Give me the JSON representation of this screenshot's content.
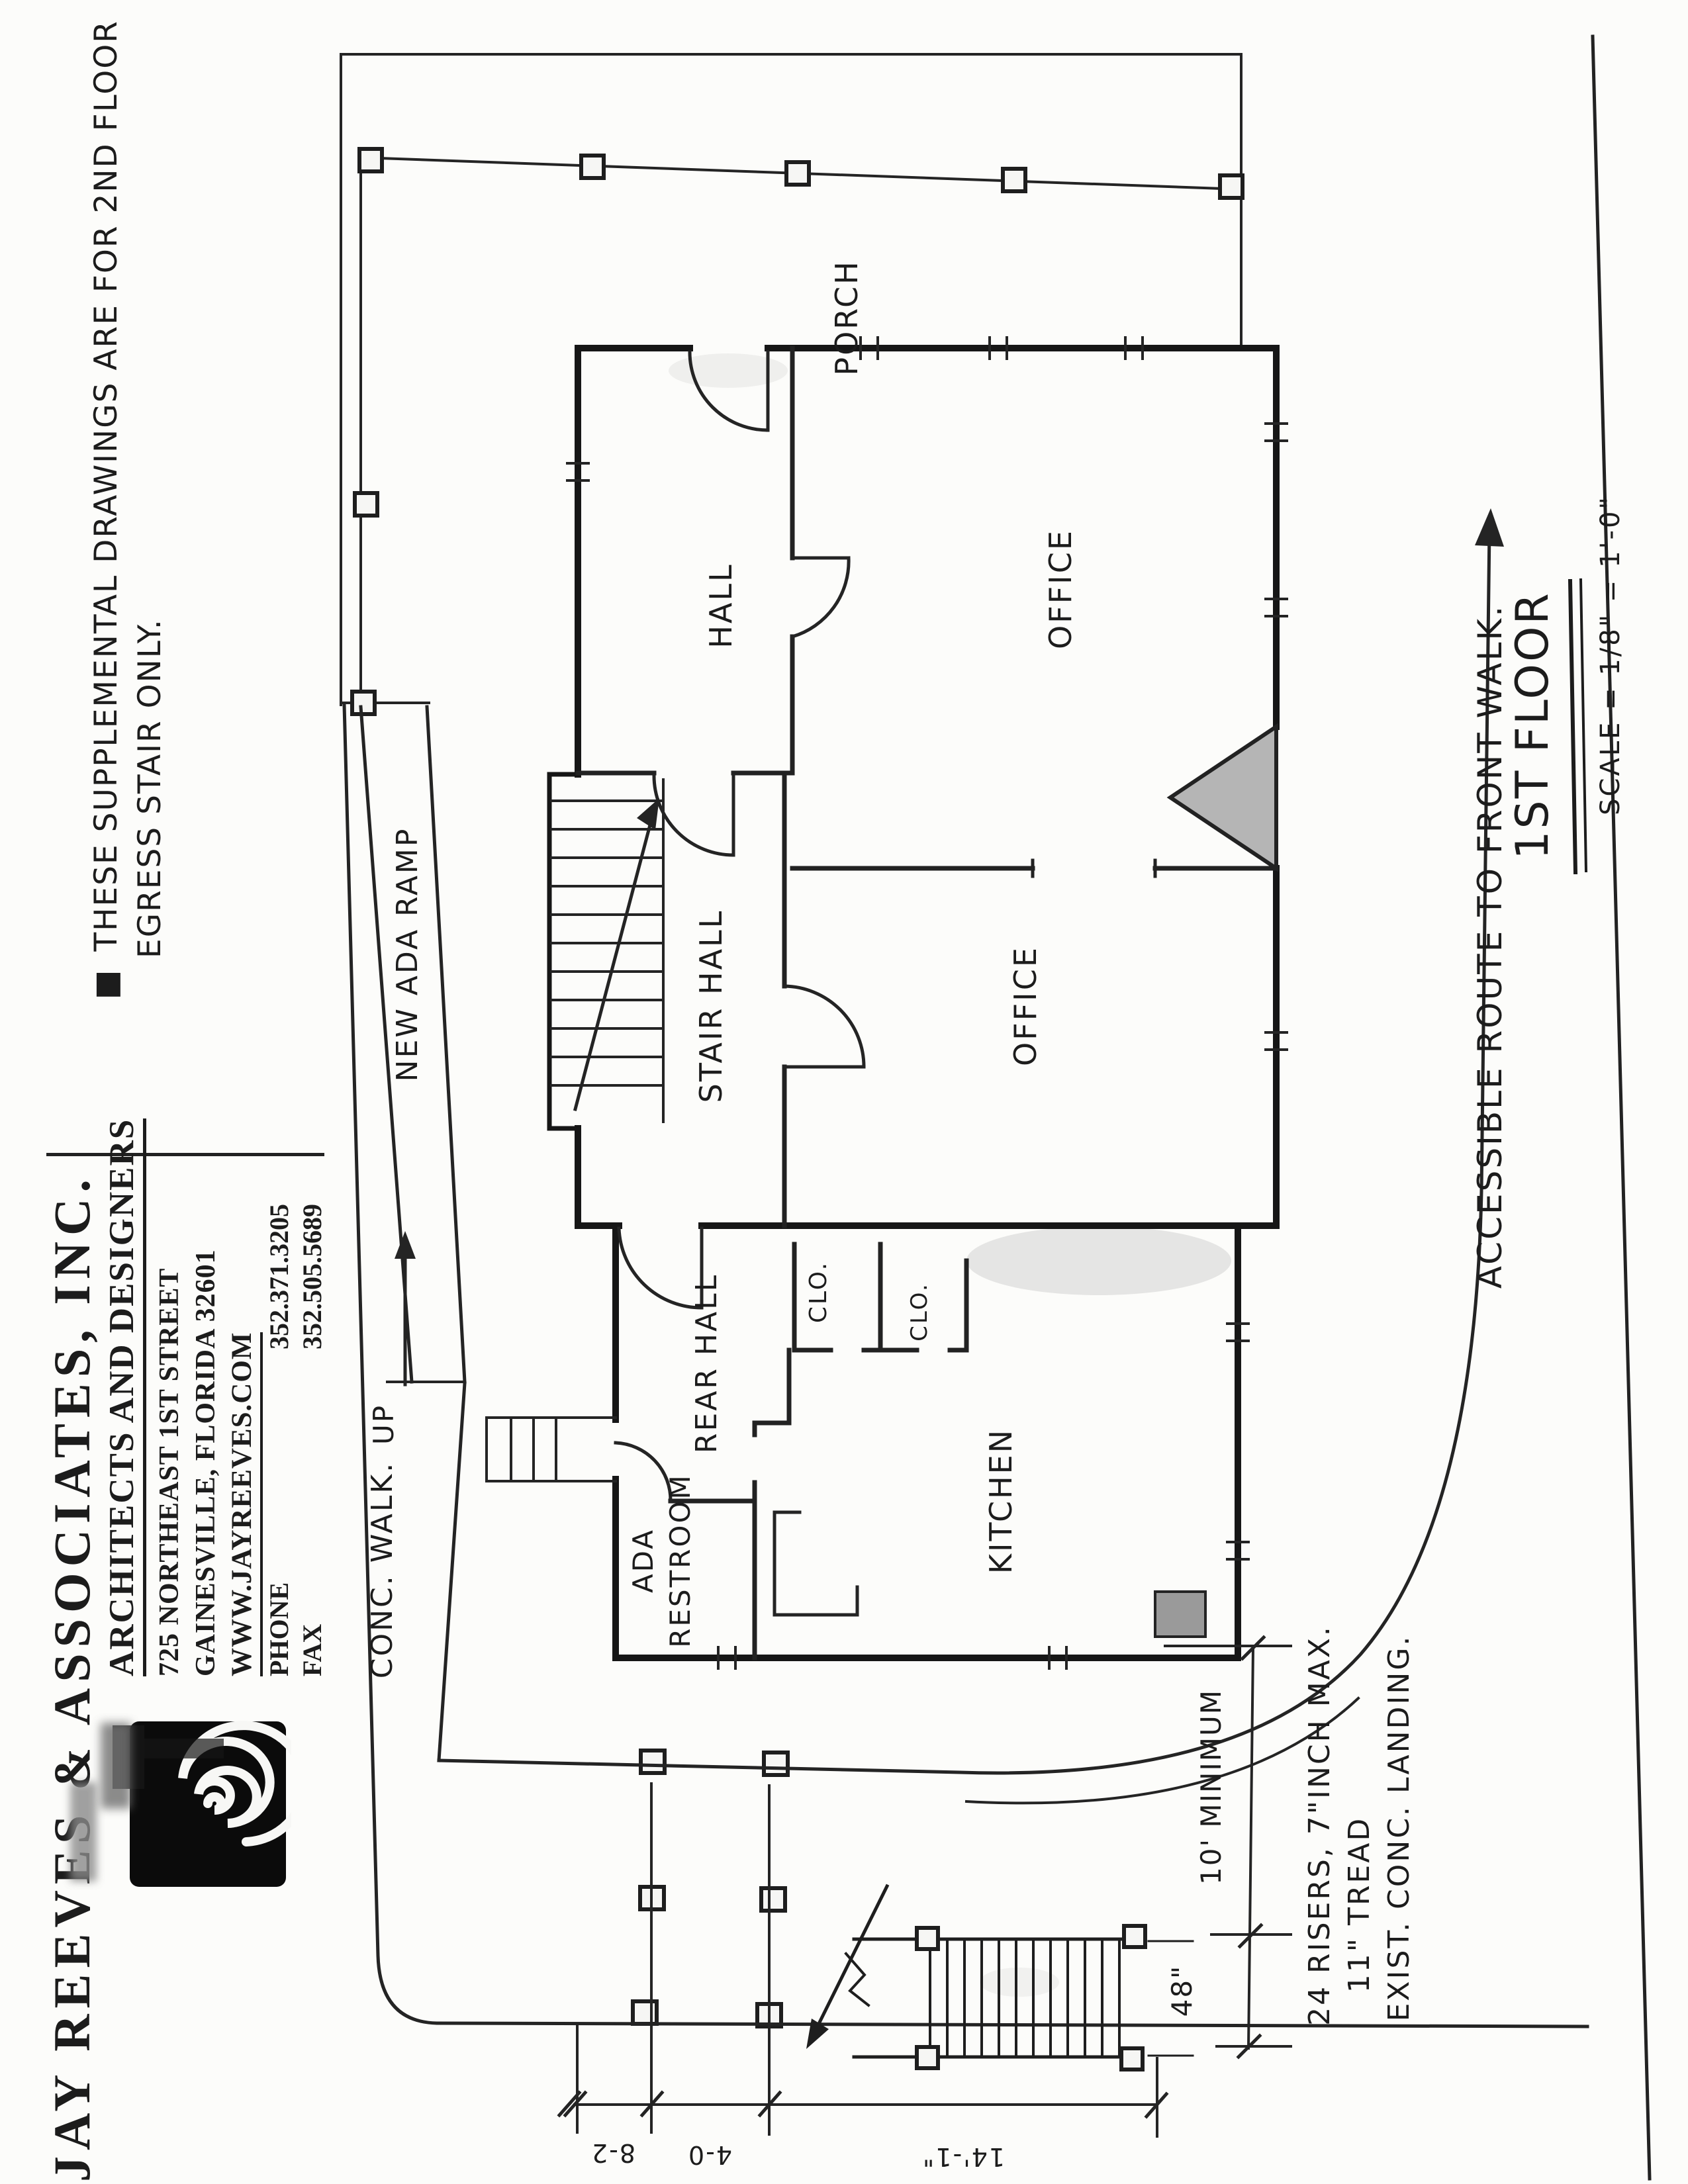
{
  "note": {
    "bullet": "■",
    "line1": "THESE SUPPLEMENTAL DRAWINGS ARE FOR 2ND FLOOR",
    "line2": "EGRESS STAIR ONLY."
  },
  "title_block": {
    "firm": "JAY REEVES & ASSOCIATES, INC.",
    "tagline": "ARCHITECTS AND DESIGNERS",
    "address_line1": "725 NORTHEAST 1ST STREET",
    "address_line2": "GAINESVILLE, FLORIDA 32601",
    "website": "WWW.JAYREEVES.COM",
    "phone_label": "PHONE",
    "phone_number": "352.371.3205",
    "fax_label": "FAX",
    "fax_number": "352.505.5689"
  },
  "plan": {
    "rooms": {
      "porch": "PORCH",
      "hall": "HALL",
      "office_front": "OFFICE",
      "stair_hall": "STAIR HALL",
      "office_rear": "OFFICE",
      "rear_hall": "REAR HALL",
      "closet1": "CLO.",
      "closet2": "CLO.",
      "kitchen": "KITCHEN",
      "restroom_line1": "ADA",
      "restroom_line2": "RESTROOM"
    },
    "annotations": {
      "ramp": "NEW ADA RAMP",
      "up": "UP",
      "conc_walk": "CONC. WALK.",
      "route": "ACCESSIBLE ROUTE TO FRONT WALK.",
      "stair_note_line1": "24 RISERS, 7\"INCH MAX.",
      "stair_note_line2": "11\" TREAD",
      "stair_note_line3": "EXIST. CONC. LANDING."
    },
    "dimensions": {
      "min_clearance": "10' MINIMUM",
      "stair_width": "48\"",
      "dim1": "8-2",
      "dim2": "4-0",
      "dim3": "14'-1\""
    }
  },
  "drawing_title": {
    "title": "1ST FLOOR",
    "scale": "SCALE = 1/8\" = 1'-0\""
  },
  "colors": {
    "ink": "#1c1c1c",
    "masonry_shade": "#b5b5b5",
    "appliance_shade": "#9a9a9a"
  }
}
